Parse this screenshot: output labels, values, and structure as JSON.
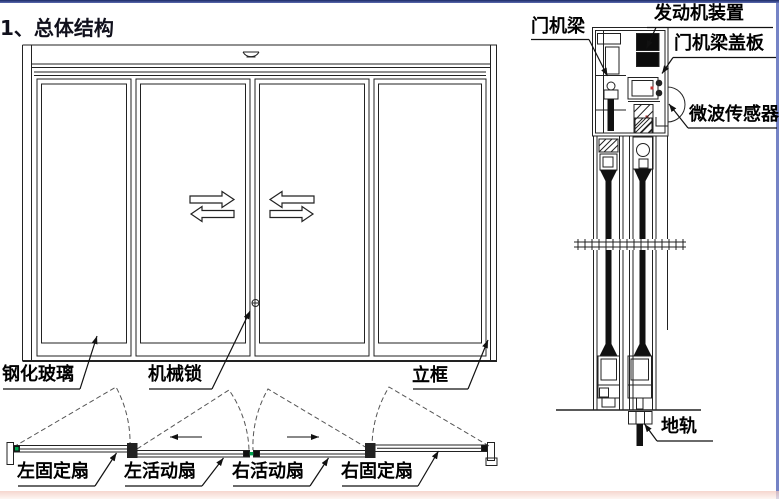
{
  "title": "1、总体结构",
  "colors": {
    "line": "#222222",
    "accent_green": "#00a550",
    "machine_red": "#c23232",
    "border_top": "#1c2a66",
    "border_right": "#7583c6",
    "border_bottom": "#f2c8be"
  },
  "front_view": {
    "labels": {
      "tempered_glass": "钢化玻璃",
      "mechanical_lock": "机械锁",
      "vertical_frame": "立框"
    }
  },
  "plan_view": {
    "labels": {
      "left_fixed_panel": "左固定扇",
      "left_sliding_panel": "左活动扇",
      "right_sliding_panel": "右活动扇",
      "right_fixed_panel": "右固定扇"
    }
  },
  "section_view": {
    "labels": {
      "door_operator_beam": "门机梁",
      "motor_unit": "发动机装置",
      "beam_cover": "门机梁盖板",
      "microwave_sensor": "微波传感器",
      "floor_track": "地轨"
    }
  }
}
